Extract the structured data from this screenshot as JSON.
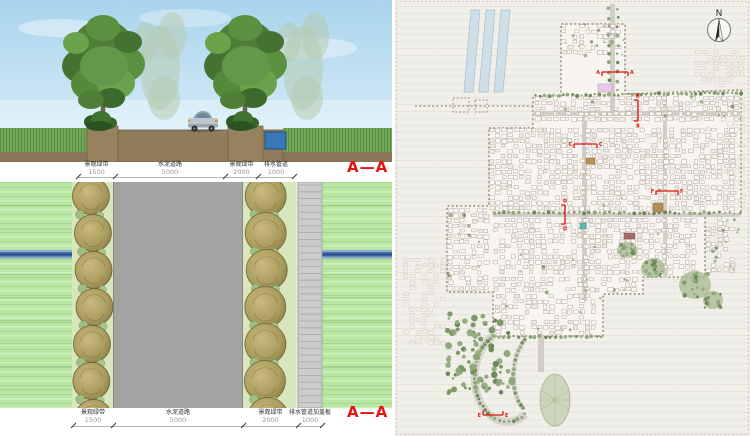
{
  "section_view": {
    "title": "A—A",
    "dimensions": [
      {
        "label": "景观绿带",
        "value": "1500"
      },
      {
        "label": "水泥道路",
        "value": "5000"
      },
      {
        "label": "景观绿带",
        "value": "2000"
      },
      {
        "label": "排水管道",
        "value": "1000"
      }
    ],
    "ticks": [
      78,
      115,
      225,
      258,
      294
    ]
  },
  "plan_view": {
    "title": "A—A",
    "dimensions": [
      {
        "label": "景观绿带",
        "value": "1500"
      },
      {
        "label": "水泥道路",
        "value": "5000"
      },
      {
        "label": "景观绿带",
        "value": "2000"
      },
      {
        "label": "排水管道加盖板",
        "value": "1000"
      }
    ],
    "ticks": [
      73,
      113,
      243,
      298,
      322
    ]
  },
  "site_plan": {
    "north_label": "N",
    "marker_color": "#e01212",
    "markers": [
      {
        "label": "A",
        "orient": "h",
        "x1": 207,
        "x2": 233,
        "y": 72,
        "tick": "down"
      },
      {
        "label": "B",
        "orient": "v",
        "x": 243,
        "y1": 100,
        "y2": 121,
        "tick": "left"
      },
      {
        "label": "C",
        "orient": "h",
        "x1": 179,
        "x2": 202,
        "y": 144,
        "tick": "down"
      },
      {
        "label": "D",
        "orient": "v",
        "x": 170,
        "y1": 205,
        "y2": 224,
        "tick": "left"
      },
      {
        "label": "E",
        "orient": "h",
        "x1": 88,
        "x2": 108,
        "y": 415,
        "tick": "up"
      },
      {
        "label": "F",
        "orient": "h",
        "x1": 261,
        "x2": 283,
        "y": 191,
        "tick": "down"
      }
    ]
  }
}
